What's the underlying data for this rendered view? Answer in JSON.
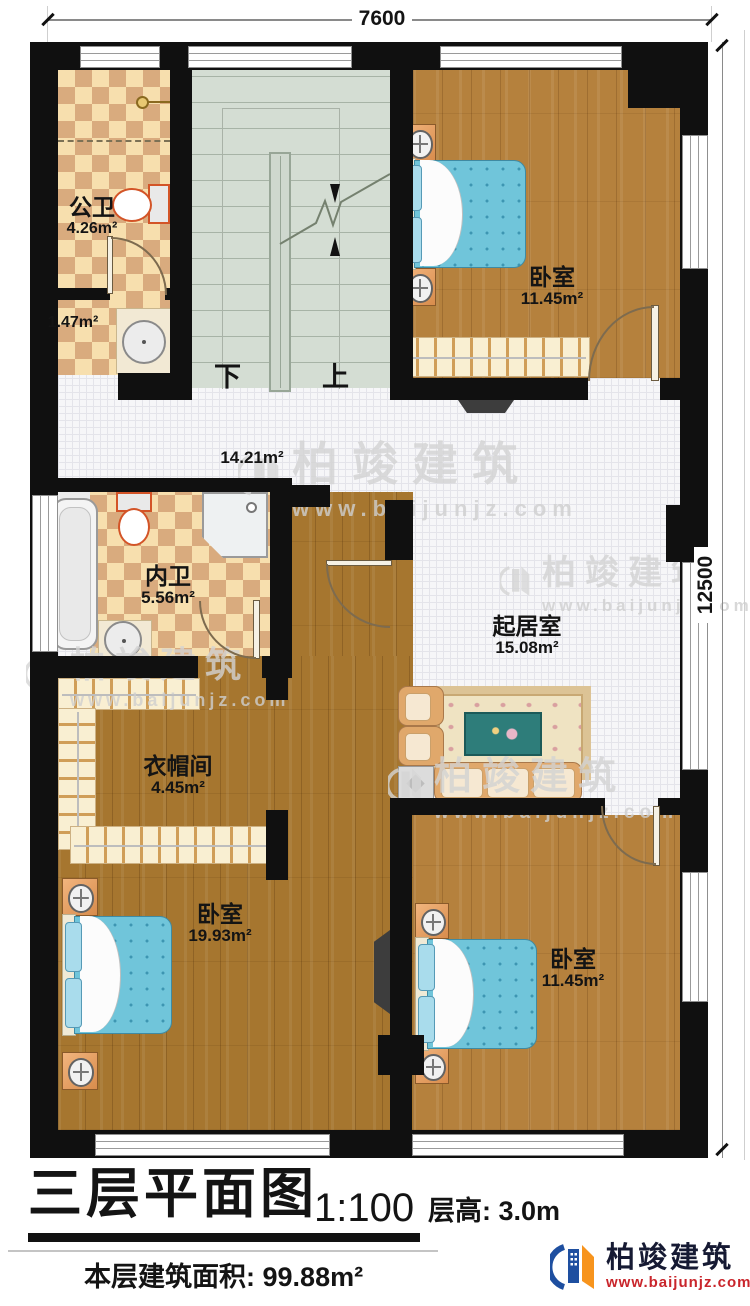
{
  "dim_top": "7600",
  "dim_right": "12500",
  "rooms": {
    "public_bath": {
      "name": "公卫",
      "area": "4.26m²"
    },
    "bath_lobby": {
      "area": "1.47m²"
    },
    "bedroom_top": {
      "name": "卧室",
      "area": "11.45m²"
    },
    "hallway": {
      "area": "14.21m²"
    },
    "ensuite_bath": {
      "name": "内卫",
      "area": "5.56m²"
    },
    "living_room": {
      "name": "起居室",
      "area": "15.08m²"
    },
    "cloakroom": {
      "name": "衣帽间",
      "area": "4.45m²"
    },
    "bedroom_left": {
      "name": "卧室",
      "area": "19.93m²"
    },
    "bedroom_right": {
      "name": "卧室",
      "area": "11.45m²"
    }
  },
  "stairs": {
    "down_label": "下",
    "up_label": "上"
  },
  "title_block": {
    "title": "三层平面图",
    "scale": "1:100",
    "floor_height_label": "层高:",
    "floor_height_value": "3.0m",
    "floor_area_label": "本层建筑面积:",
    "floor_area_value": "99.88m²"
  },
  "brand": {
    "name": "柏竣建筑",
    "website": "www.baijunjz.com"
  },
  "watermark": {
    "name": "柏竣建筑",
    "website": "www.baijunjz.com"
  },
  "colors": {
    "wall": "#101010",
    "tile_light": "#f7dfae",
    "tile_dark": "#d9ab7e",
    "wood_light": "#b5813d",
    "wood_dark": "#a6762f",
    "stair": "#d4ddd3",
    "bed": "#70c5da",
    "brand_blue": "#1e4fa0",
    "brand_orange": "#f7941d",
    "brand_red": "#c9252b"
  }
}
